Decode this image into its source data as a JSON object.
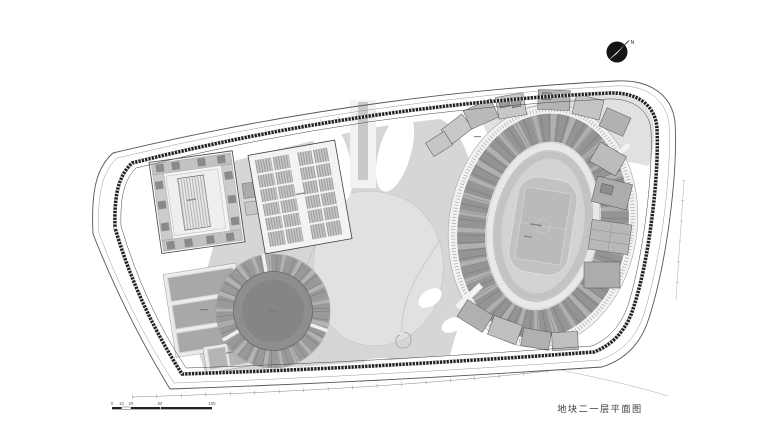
{
  "plan": {
    "caption": "地块二一层平面图",
    "north": {
      "label": "N"
    },
    "scale_bar": {
      "labels": [
        "0",
        "10",
        "20",
        "50",
        "100"
      ]
    },
    "colors": {
      "paper": "#ffffff",
      "plaza": "#d6d6d6",
      "plaza_light": "#e1e1e1",
      "boundary": "#1f1f1f",
      "building_light": "#c6c6c6",
      "building_dark": "#8a8a8a",
      "arena_floor": "#8e8e8e",
      "stand_ring": "#949494",
      "track": "#d3d3d3",
      "infield": "#c2c2c2",
      "north_circle": "#141414"
    }
  }
}
